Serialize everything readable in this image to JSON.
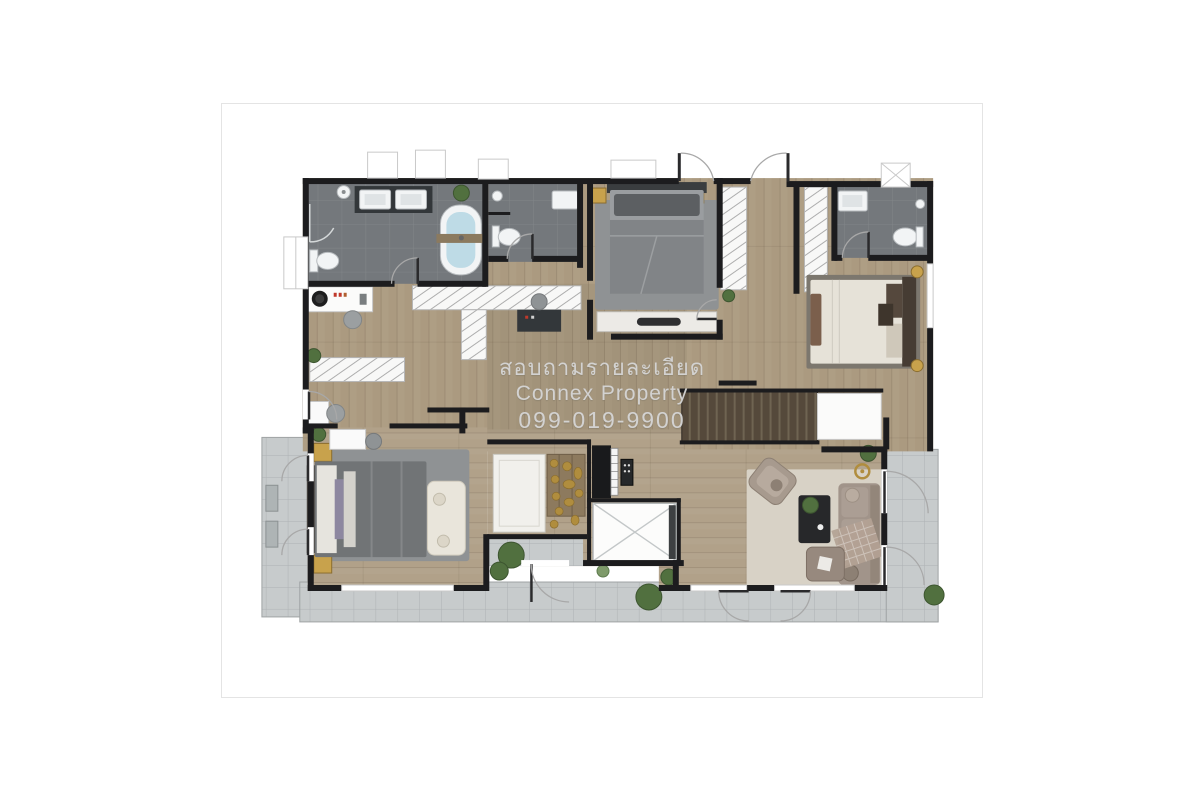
{
  "watermark": {
    "line1": "สอบถามรายละเอียด",
    "line2": "Connex Property",
    "line3": "099-019-9900"
  },
  "palette": {
    "wall": "#1c1c1e",
    "wood": "#ab9a80",
    "wood_room": "#b1a189",
    "bath_tile": "#74787c",
    "counter_dark": "#33373a",
    "balcony": "#c7cbcc",
    "rug_gray": "#8f9294",
    "rug_taupe": "#7c776e",
    "rug_cream": "#d8d2c6",
    "bed_dark_duvet": "#717476",
    "bed_cream": "#e6e2d8",
    "stairs_base": "#55493b",
    "stair_tread": "#6f6452",
    "sofa_taupe": "#a1948a",
    "tub_water": "#bedbe6",
    "gold_decor": "#b08d3e",
    "lamp_glow": "#c8a24c",
    "plant_green": "#51703f",
    "watermark_text": "#d6d6d6"
  },
  "rooms": [
    "master-bathroom",
    "bathroom-2",
    "bathroom-3",
    "bedroom-2",
    "bedroom-3",
    "master-bedroom",
    "dressing-area",
    "walk-in-wardrobe",
    "shrine-room",
    "piano-nook",
    "stair-hall",
    "void-shaft",
    "living-area",
    "balcony-left",
    "balcony-bottom",
    "balcony-right"
  ]
}
